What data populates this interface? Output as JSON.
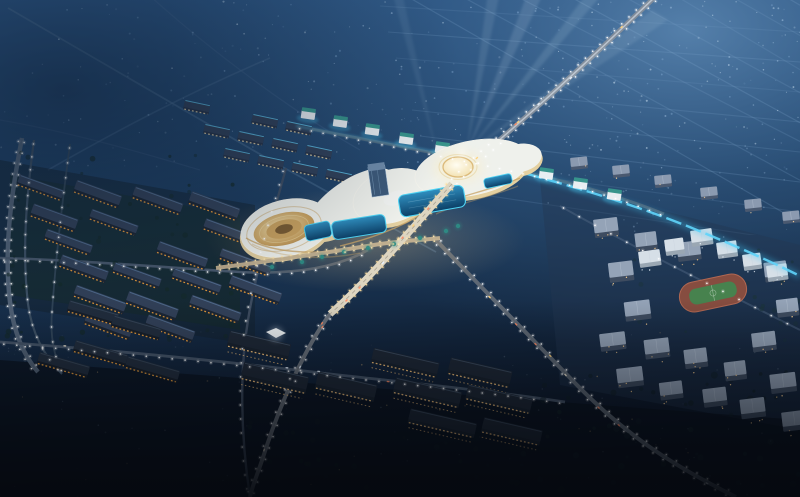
{
  "scene": {
    "name": "aerial-night-masterplan-render",
    "description": "Photorealistic aerial night rendering of a city master plan: an illuminated curvilinear shopping-mall complex with a glowing dome and swimming pools at center, a lit arterial road bridging across it, searchlight beams fanning into the sky, dark residential slab blocks with warm lit windows on the left and bottom, a grid of apartment blocks with a running-track sports field on the right, and faint farmland grid roads receding to the top right.",
    "elements": [
      {
        "name": "central-mall-complex",
        "label": "curvilinear terraced mall with white roof and gold terraces"
      },
      {
        "name": "glowing-dome",
        "label": "circular glowing rooftop dome"
      },
      {
        "name": "ring-courtyard",
        "label": "oval terraced courtyard bowl"
      },
      {
        "name": "glass-tower",
        "label": "small blue glass tower on mall roof"
      },
      {
        "name": "swimming-pools",
        "label": "cyan-lit pools flanking the bridge"
      },
      {
        "name": "road-bridge",
        "label": "bright lit road crossing the complex"
      },
      {
        "name": "searchlight-beams",
        "label": "light beams fanning to upper sky"
      },
      {
        "name": "neon-strip",
        "label": "cyan neon lit edge running to the right"
      },
      {
        "name": "pavilion-row",
        "label": "small white pavilions with teal roofs"
      },
      {
        "name": "slab-housing",
        "label": "dark housing slabs with orange window rows"
      },
      {
        "name": "apartment-grid",
        "label": "grid of apartment blocks lower right"
      },
      {
        "name": "sports-field",
        "label": "green pitch with red running track"
      },
      {
        "name": "elevated-ramp",
        "label": "lamp-lined elevated road on left edge"
      },
      {
        "name": "farmland-grid",
        "label": "faint field grid roads top right"
      },
      {
        "name": "street-lamps",
        "label": "white street lamp dots along roads"
      },
      {
        "name": "cars",
        "label": "small vehicles on main roads"
      }
    ],
    "counts": {
      "beams": 5,
      "pools": 4,
      "pavilions": 9,
      "speckles": 500,
      "housing_zones": 6
    },
    "palette": {
      "sky_top": "#2c5583",
      "sky_mid": "#1d3d60",
      "sky_deep": "#13263e",
      "ground_bottom": "#0a1322",
      "sky_light_tr": "#5d89b4",
      "grid_line": "#7fa6cc",
      "faint_road": "#4e7296",
      "road_dim": "#46566a",
      "road_medium": "#808c9a",
      "road_bright": "#ddd5c1",
      "road_glow_warm": "#ffe0a0",
      "lamp_white": "#ffffff",
      "lamp_warm": "#ffe7b0",
      "complex_white": "#eff1ec",
      "complex_cream": "#e4d0a0",
      "terrace_gold": "#c9a365",
      "bowl_light": "#f4e3b2",
      "bowl_dark": "#a9824a",
      "dome_light": "#fffdf2",
      "dome_edge": "#dcba7a",
      "tower_glass": "#3d5a7a",
      "pool_light": "#2f8fc0",
      "pool_deep": "#0c3f66",
      "pool_neon": "#4fd4f4",
      "neon_strip": "#3cc3f2",
      "window_warm": "#f0a13c",
      "window_bright": "#ffc97e",
      "slab_roof": "#33425a",
      "slab_sheen": "#5d7da2",
      "slab_body": "#1c2634",
      "apt_roof": "#94a3b7",
      "apt_body": "#3e4c60",
      "pavilion_wall": "#e8eef2",
      "pavilion_roof": "#37948c",
      "white_block_roof": "#d6dfe7",
      "white_block_body": "#9aa7b3",
      "field_green": "#47824e",
      "track_red": "#8c4f40",
      "tree_dark": "#142a28",
      "tree_teal": "#2e8b84",
      "beam_light": "#d8ebfa",
      "glow_warm": "#f0c98a",
      "speckle_blue": "#86add4",
      "speckle_warm": "#d8b478"
    }
  }
}
